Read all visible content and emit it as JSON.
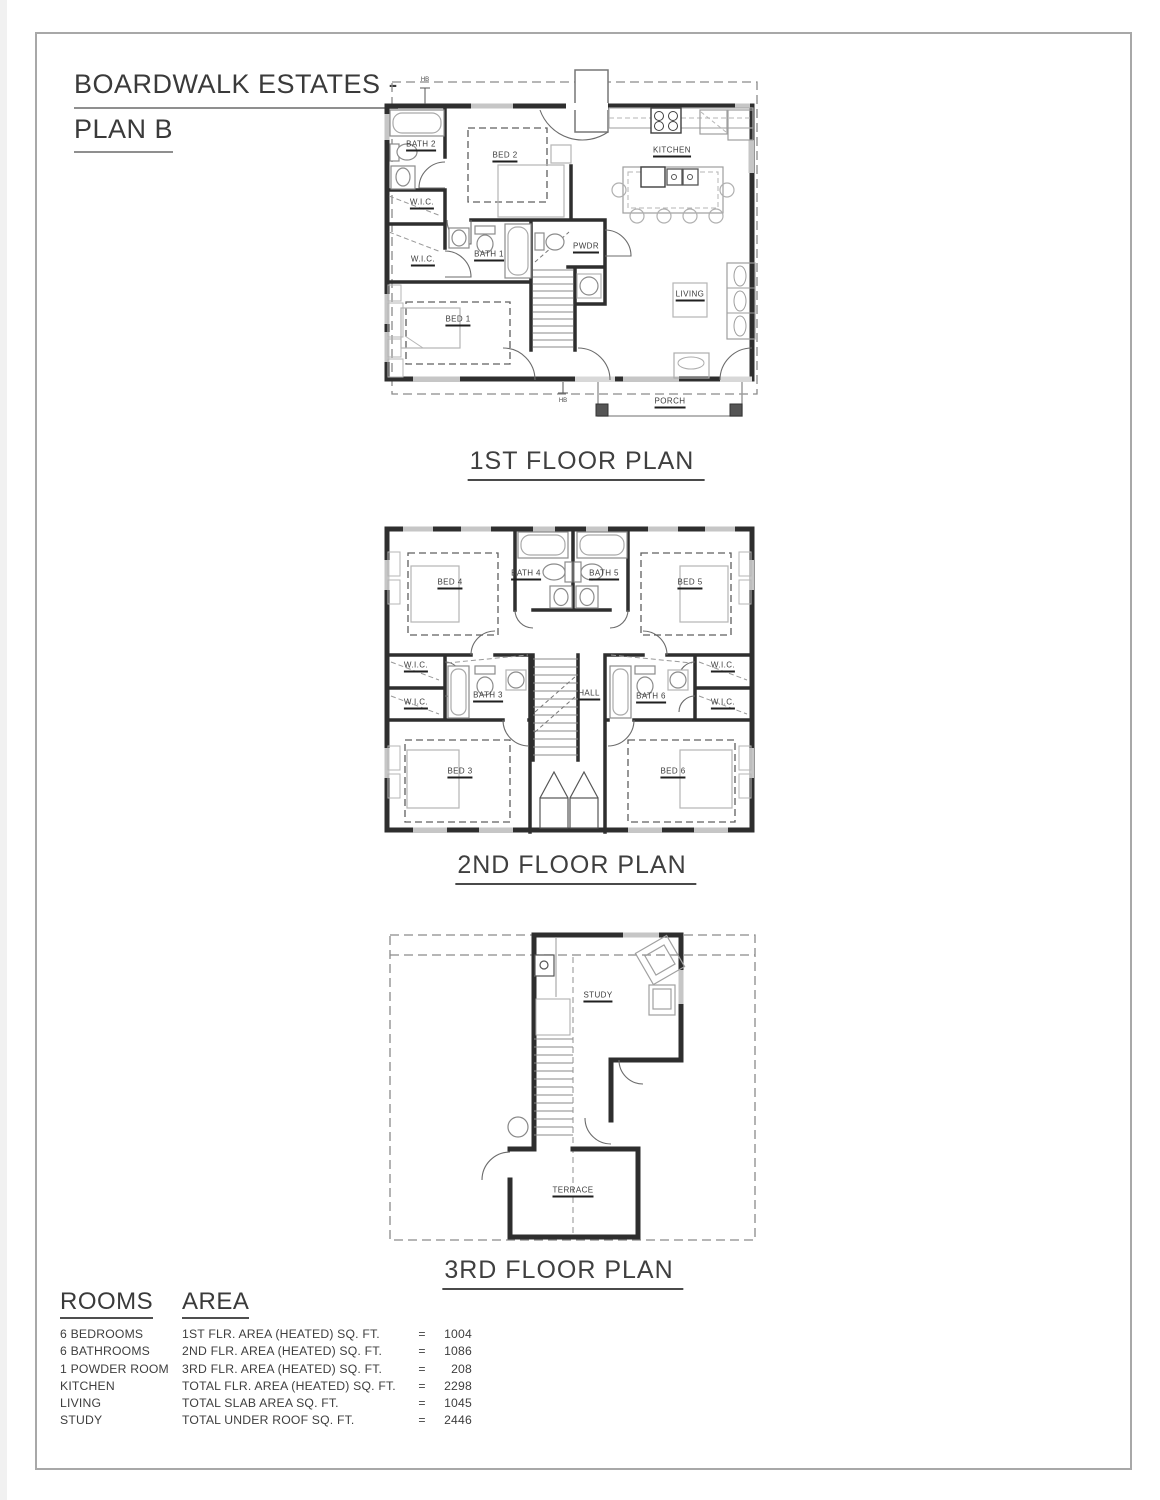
{
  "title": {
    "line1": "BOARDWALK ESTATES -",
    "line2": "PLAN B"
  },
  "floor1": {
    "caption": "1ST FLOOR PLAN",
    "labels": {
      "bath2": "BATH 2",
      "bed2": "BED 2",
      "kitchen": "KITCHEN",
      "wic_upper": "W.I.C.",
      "wic_lower": "W.I.C.",
      "bath1": "BATH 1",
      "pwdr": "PWDR",
      "bed1": "BED 1",
      "living": "LIVING",
      "porch": "PORCH",
      "hb_top": "HB",
      "hb_bottom": "HB"
    }
  },
  "floor2": {
    "caption": "2ND FLOOR PLAN",
    "labels": {
      "bed4": "BED 4",
      "bath4": "BATH 4",
      "bath5": "BATH 5",
      "bed5": "BED 5",
      "wic_left_upper": "W.I.C.",
      "wic_left_lower": "W.I.C.",
      "wic_right_upper": "W.I.C.",
      "wic_right_lower": "W.I.C.",
      "bath3": "BATH 3",
      "hall": "HALL",
      "bath6": "BATH 6",
      "bed3": "BED 3",
      "bed6": "BED 6"
    }
  },
  "floor3": {
    "caption": "3RD FLOOR PLAN",
    "labels": {
      "study": "STUDY",
      "terrace": "TERRACE"
    }
  },
  "summary": {
    "rooms_header": "ROOMS",
    "area_header": "AREA",
    "rows": [
      {
        "room": "6 BEDROOMS",
        "area": "1ST FLR. AREA (HEATED) SQ. FT.",
        "eq": "=",
        "value": "1004"
      },
      {
        "room": "6 BATHROOMS",
        "area": "2ND FLR. AREA (HEATED) SQ. FT.",
        "eq": "=",
        "value": "1086"
      },
      {
        "room": "1 POWDER ROOM",
        "area": "3RD FLR. AREA (HEATED) SQ. FT.",
        "eq": "=",
        "value": "208"
      },
      {
        "room": "KITCHEN",
        "area": "TOTAL FLR. AREA (HEATED) SQ. FT.",
        "eq": "=",
        "value": "2298"
      },
      {
        "room": "LIVING",
        "area": "TOTAL SLAB AREA SQ. FT.",
        "eq": "=",
        "value": "1045"
      },
      {
        "room": "STUDY",
        "area": "TOTAL UNDER ROOF SQ. FT.",
        "eq": "=",
        "value": "2446"
      }
    ]
  }
}
